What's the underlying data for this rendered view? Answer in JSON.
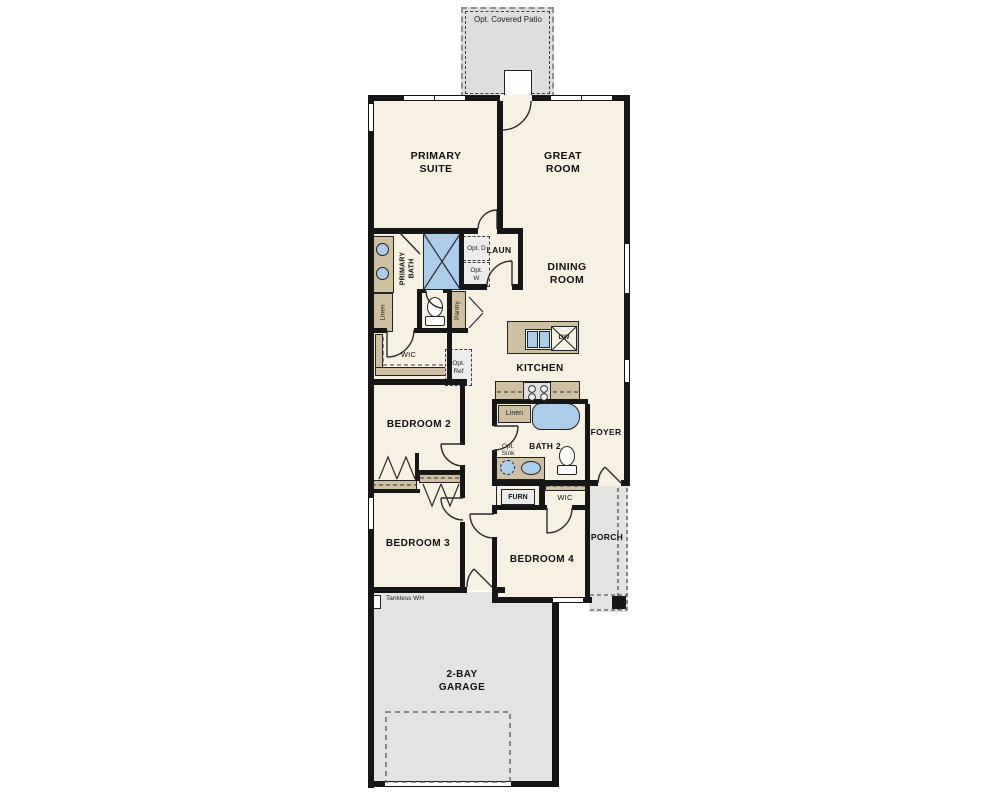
{
  "plan_type": "single-story floor plan",
  "rooms": {
    "patio": "Opt. Covered Patio",
    "primary_suite": "PRIMARY SUITE",
    "great_room": "GREAT ROOM",
    "dining_room": "DINING ROOM",
    "kitchen": "KITCHEN",
    "primary_bath": "PRIMARY BATH",
    "laundry": "LAUN",
    "wic_primary": "WIC",
    "bedroom_2": "BEDROOM 2",
    "bedroom_3": "BEDROOM 3",
    "bedroom_4": "BEDROOM 4",
    "bath_2": "BATH 2",
    "foyer": "FOYER",
    "wic_bedroom4": "WIC",
    "porch": "PORCH",
    "garage": "2-BAY GARAGE"
  },
  "features": {
    "linen_primary": "Linen",
    "pantry": "Pantry",
    "opt_dryer": "Opt. D",
    "opt_washer": "Opt. W",
    "opt_ref": "Opt. Ref",
    "linen_bath2": "Linen",
    "opt_sink": "Opt. Sink",
    "furnace": "FURN",
    "dishwasher": "DW",
    "tankless_water_heater": "Tankless WH"
  },
  "colors": {
    "wall": "#161616",
    "floor": "#f7f1e3",
    "cabinetry": "#cfc0a2",
    "fixtures": "#abcde9",
    "concrete": "#e3e3e2",
    "background": "#ffffff"
  }
}
